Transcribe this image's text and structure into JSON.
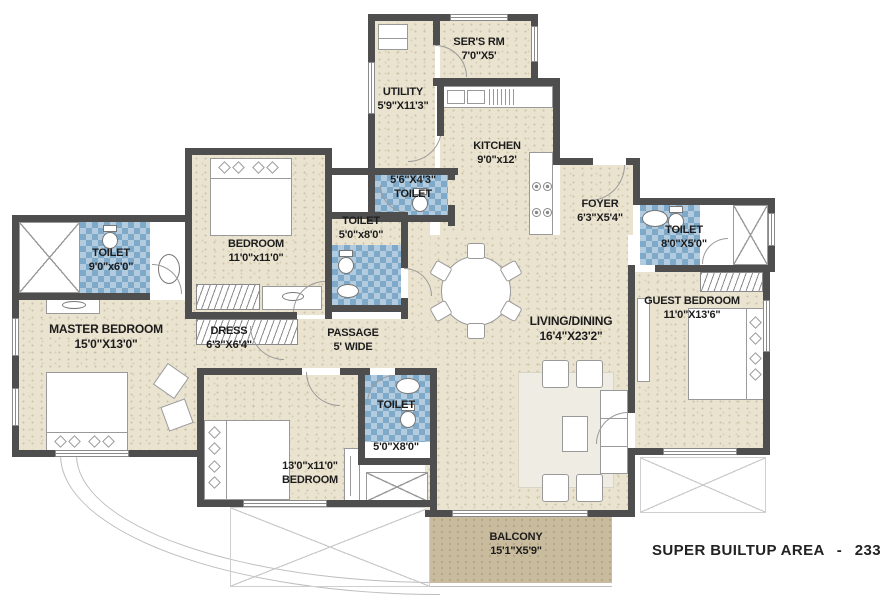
{
  "plan_title": "Apartment Floor Plan",
  "rooms": [
    {
      "id": "sers-rm",
      "name": "SER'S RM",
      "dims": "7'0\"X5'"
    },
    {
      "id": "utility",
      "name": "UTILITY",
      "dims": "5'9\"X11'3\""
    },
    {
      "id": "kitchen",
      "name": "KITCHEN",
      "dims": "9'0\"x12'"
    },
    {
      "id": "toilet-kitchen",
      "name": "TOILET",
      "dims": "5'6\"X4'3\""
    },
    {
      "id": "toilet-passage",
      "name": "TOILET",
      "dims": "5'0\"x8'0\""
    },
    {
      "id": "foyer",
      "name": "FOYER",
      "dims": "6'3\"X5'4\""
    },
    {
      "id": "toilet-right",
      "name": "TOILET",
      "dims": "8'0\"X5'0\""
    },
    {
      "id": "toilet-master",
      "name": "TOILET",
      "dims": "9'0\"x6'0\""
    },
    {
      "id": "bedroom-2",
      "name": "BEDROOM",
      "dims": "11'0\"x11'0\""
    },
    {
      "id": "master-bedroom",
      "name": "MASTER BEDROOM",
      "dims": "15'0\"X13'0\""
    },
    {
      "id": "dress",
      "name": "DRESS",
      "dims": "6'3\"X6'4\""
    },
    {
      "id": "passage",
      "name": "PASSAGE",
      "dims": "5' WIDE"
    },
    {
      "id": "living-dining",
      "name": "LIVING/DINING",
      "dims": "16'4\"X23'2\""
    },
    {
      "id": "guest-bedroom",
      "name": "GUEST BEDROOM",
      "dims": "11'0\"X13'6\""
    },
    {
      "id": "toilet-common",
      "name": "TOILET",
      "dims": "5'0\"X8'0\""
    },
    {
      "id": "bedroom-3",
      "name": "BEDROOM",
      "dims": "13'0\"x11'0\""
    },
    {
      "id": "balcony",
      "name": "BALCONY",
      "dims": "15'1\"X5'9\""
    }
  ],
  "footer": {
    "label": "SUPER BUILTUP AREA",
    "separator": "-",
    "value": "2330 sft."
  },
  "colors": {
    "wall": "#4e4e4e",
    "floor": "#eae3d0",
    "toilet_tile": "#7fa9c9",
    "balcony": "#c9bb9d",
    "text": "#1c1c1c"
  }
}
